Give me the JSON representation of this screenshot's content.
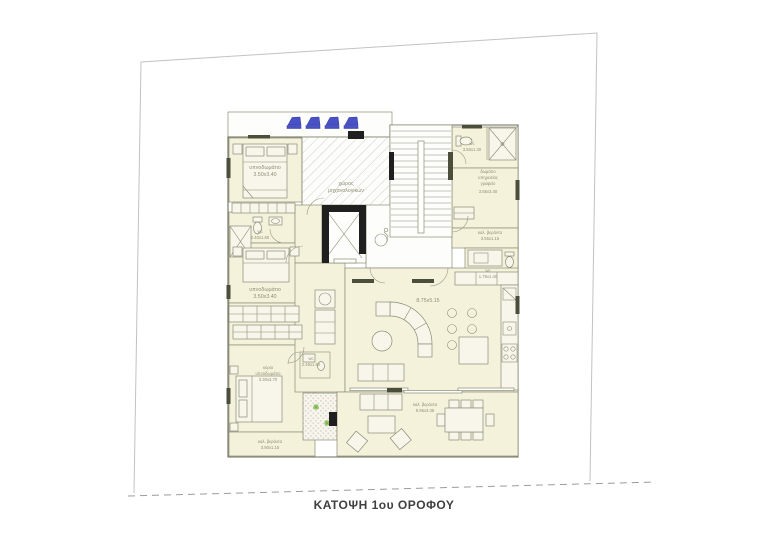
{
  "page": {
    "title": "ΚΑΤΟΨΗ 1ου ΟΡΟΦΟΥ"
  },
  "colors": {
    "paper": "#ffffff",
    "room_fill": "#f5f2dc",
    "furniture_fill": "#f8f6ea",
    "wall_line": "#6a6d57",
    "dark_fill": "#1f1f1f",
    "window_fill": "#4b4e3b",
    "solar_blue": "#4851c5",
    "label_text": "#8f8f74",
    "title_text": "#3f3f3f",
    "plant_green": "#7ab648"
  },
  "rooms": {
    "bedroom1": {
      "name": "υπνοδωμάτιο",
      "dims": "3.50x3.40"
    },
    "mechanical": {
      "name": "χώρος",
      "name2": "μηχανολογικών"
    },
    "wc_left": {
      "name": "wc",
      "dims": "2.40x1.60"
    },
    "bedroom2": {
      "name": "υπνοδωμάτιο",
      "dims": "3.50x3.40"
    },
    "master_bedroom": {
      "name": "κύριο",
      "name2": "υπνοδωμάτιο",
      "dims": "3.30x3.70"
    },
    "veranda_left": {
      "name": "καλ. βεράντα",
      "dims": "3.90x1.15"
    },
    "wc_top": {
      "name": "wc",
      "dims": "3.50x1.30"
    },
    "office": {
      "name": "δωμάτιο",
      "name2": "υπηρεσίας",
      "name3": "γραφείο",
      "dims": "3.55x3.40"
    },
    "veranda_right": {
      "name": "καλ. βεράντα",
      "dims": "3.55x1.15"
    },
    "wc_service": {
      "name": "wc",
      "dims": "1.75x1.40"
    },
    "living": {
      "dims": "8.75x5.15"
    },
    "wc_central": {
      "name": "wc",
      "dims": "2.45x1.60"
    },
    "veranda_main": {
      "name": "καλ. βεράντα",
      "dims": "9.95x3.35"
    }
  }
}
